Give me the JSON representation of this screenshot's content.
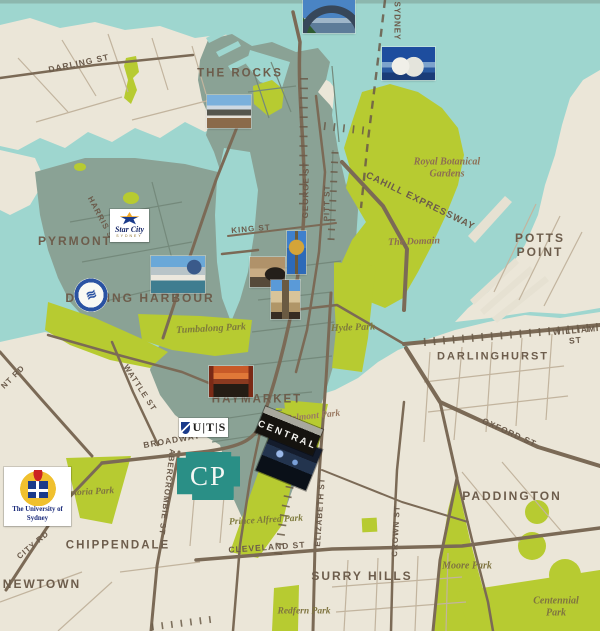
{
  "map": {
    "title": "Sydney inner-city tourist map",
    "colors": {
      "water": "#9ed6cf",
      "land": "#ebe6d8",
      "cbd_green": "#8aa295",
      "park_green": "#b7cb31",
      "road_brown": "#7b6a56",
      "label_brown": "#6d5d4c",
      "cp_teal": "#2a8f86"
    },
    "labels": {
      "area": [
        {
          "id": "the-rocks",
          "text": "THE ROCKS",
          "x": 240,
          "y": 74,
          "rot": 0,
          "size": 11.5
        },
        {
          "id": "pyrmont",
          "text": "PYRMONT",
          "x": 75,
          "y": 242,
          "rot": 0,
          "size": 12
        },
        {
          "id": "darling-harbour",
          "text": "DARLING HARBOUR",
          "x": 140,
          "y": 299,
          "rot": 0,
          "size": 12
        },
        {
          "id": "potts-point",
          "text": "POTTS POINT",
          "x": 540,
          "y": 246,
          "rot": 0,
          "size": 12
        },
        {
          "id": "haymarket",
          "text": "HAYMARKET",
          "x": 257,
          "y": 400,
          "rot": 0,
          "size": 11.5
        },
        {
          "id": "darlinghurst",
          "text": "DARLINGHURST",
          "x": 493,
          "y": 357,
          "rot": 0,
          "size": 11
        },
        {
          "id": "chippendale",
          "text": "CHIPPENDALE",
          "x": 118,
          "y": 546,
          "rot": 0,
          "size": 11.5
        },
        {
          "id": "newtown",
          "text": "NEWTOWN",
          "x": 42,
          "y": 585,
          "rot": 0,
          "size": 12
        },
        {
          "id": "surry-hills",
          "text": "SURRY HILLS",
          "x": 362,
          "y": 577,
          "rot": 0,
          "size": 12
        },
        {
          "id": "paddington",
          "text": "PADDINGTON",
          "x": 512,
          "y": 497,
          "rot": 0,
          "size": 12
        }
      ],
      "street": [
        {
          "id": "darling-st",
          "text": "DARLING ST",
          "x": 79,
          "y": 64,
          "rot": -12,
          "size": 8.5
        },
        {
          "id": "harris-st",
          "text": "HARRIS ST",
          "x": 102,
          "y": 220,
          "rot": 62,
          "size": 8
        },
        {
          "id": "king-st",
          "text": "KING ST",
          "x": 251,
          "y": 229,
          "rot": -5,
          "size": 8
        },
        {
          "id": "george-st",
          "text": "GEORGE ST",
          "x": 306,
          "y": 190,
          "rot": -89,
          "size": 8
        },
        {
          "id": "pitt-st",
          "text": "PITT ST",
          "x": 327,
          "y": 203,
          "rot": -89,
          "size": 8
        },
        {
          "id": "sydney-tunnel",
          "text": "SYDNEY",
          "x": 397,
          "y": 21,
          "rot": 90,
          "size": 8
        },
        {
          "id": "cahill-expressway",
          "text": "CAHILL EXPRESSWAY",
          "x": 420,
          "y": 202,
          "rot": 26,
          "size": 9.5
        },
        {
          "id": "william-st",
          "text": "WILLIAM ST",
          "x": 575,
          "y": 336,
          "rot": -5,
          "size": 8.5
        },
        {
          "id": "oxford-st",
          "text": "OXFORD ST",
          "x": 509,
          "y": 433,
          "rot": 24,
          "size": 8.5
        },
        {
          "id": "wattle-st",
          "text": "WATTLE ST",
          "x": 140,
          "y": 388,
          "rot": 57,
          "size": 8
        },
        {
          "id": "broadway",
          "text": "BROADWAY",
          "x": 172,
          "y": 441,
          "rot": -10,
          "size": 8.5
        },
        {
          "id": "abercrombie-st",
          "text": "ABERCROMBIE ST",
          "x": 167,
          "y": 492,
          "rot": 97,
          "size": 8
        },
        {
          "id": "city-rd",
          "text": "CITY RD",
          "x": 33,
          "y": 545,
          "rot": -40,
          "size": 8
        },
        {
          "id": "cleveland-st",
          "text": "CLEVELAND ST",
          "x": 267,
          "y": 548,
          "rot": -4,
          "size": 8.5
        },
        {
          "id": "elizabeth-st",
          "text": "ELIZABETH ST",
          "x": 320,
          "y": 512,
          "rot": -86,
          "size": 8
        },
        {
          "id": "crown-st",
          "text": "CROWN ST",
          "x": 396,
          "y": 531,
          "rot": -87,
          "size": 8
        },
        {
          "id": "nt-rd",
          "text": "NT RD",
          "x": 13,
          "y": 377,
          "rot": -45,
          "size": 8
        }
      ],
      "park": [
        {
          "id": "royal-botanical-gardens",
          "text": "Royal Botanical\nGardens",
          "x": 447,
          "y": 168,
          "rot": 0,
          "size": 10,
          "color": "#8d6e52"
        },
        {
          "id": "the-domain",
          "text": "The Domain",
          "x": 414,
          "y": 242,
          "rot": -2,
          "size": 10,
          "color": "#8d6e52"
        },
        {
          "id": "hyde-park",
          "text": "Hyde Park",
          "x": 353,
          "y": 328,
          "rot": -2,
          "size": 10,
          "color": "#7e7a3c"
        },
        {
          "id": "tumbalong-park",
          "text": "Tumbalong Park",
          "x": 211,
          "y": 329,
          "rot": -3,
          "size": 10,
          "color": "#7e7a3c"
        },
        {
          "id": "belmont-park",
          "text": "Belmont Park",
          "x": 313,
          "y": 417,
          "rot": -6,
          "size": 9.5,
          "color": "#9a7a62"
        },
        {
          "id": "prince-alfred-park",
          "text": "Prince Alfred Park",
          "x": 266,
          "y": 521,
          "rot": -3,
          "size": 9.5,
          "color": "#7e7a3c"
        },
        {
          "id": "victoria-park",
          "text": "Victoria Park",
          "x": 88,
          "y": 493,
          "rot": -3,
          "size": 9.5,
          "color": "#7f7440"
        },
        {
          "id": "moore-park",
          "text": "Moore Park",
          "x": 467,
          "y": 566,
          "rot": 0,
          "size": 10,
          "color": "#7f7440"
        },
        {
          "id": "redfern-park",
          "text": "Redfern Park",
          "x": 304,
          "y": 612,
          "rot": 0,
          "size": 9.5,
          "color": "#7f7440"
        },
        {
          "id": "centennial-park",
          "text": "Centennial Park",
          "x": 556,
          "y": 607,
          "rot": 0,
          "size": 10,
          "color": "#7f7440"
        }
      ]
    },
    "markers": {
      "photos": [
        {
          "id": "harbour-bridge",
          "name": "Sydney Harbour Bridge photo"
        },
        {
          "id": "opera-house",
          "name": "Sydney Opera House photo"
        },
        {
          "id": "circular-quay",
          "name": "Circular Quay photo"
        },
        {
          "id": "darling-harbour",
          "name": "Darling Harbour waterfront photo"
        },
        {
          "id": "sydney-tower",
          "name": "Sydney Tower photo"
        },
        {
          "id": "qvb",
          "name": "Queen Victoria Building photo"
        },
        {
          "id": "town-hall",
          "name": "Sydney Town Hall photo"
        },
        {
          "id": "chinatown",
          "name": "Chinatown gate photo"
        },
        {
          "id": "train",
          "name": "Central station platform photo"
        }
      ],
      "star_city": {
        "title": "Star City",
        "subtitle": "SYDNEY"
      },
      "fish_market": {
        "glyph": "≋",
        "name": "Sydney Fish Market round logo"
      },
      "uts": {
        "text": "U|T|S"
      },
      "cp": {
        "text": "CP"
      },
      "central": {
        "text": "CENTRAL"
      },
      "usyd": {
        "text": "The University of Sydney"
      }
    }
  }
}
